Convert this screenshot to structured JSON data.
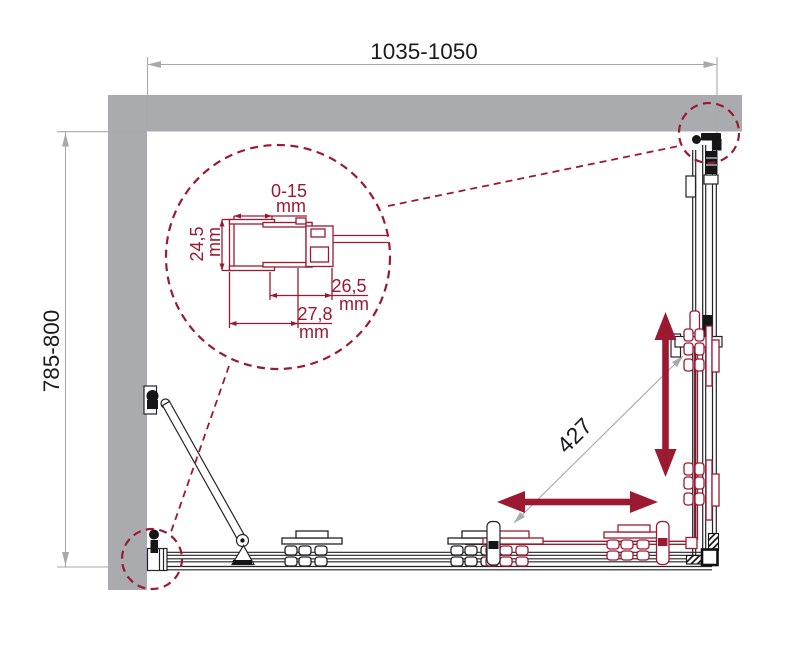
{
  "drawing": {
    "kind": "corner-shower-enclosure-plan-view",
    "dimensions": {
      "width": "1035-1050",
      "depth": "785-800",
      "diagonal": "427"
    },
    "profile_detail": {
      "adjustment": {
        "value": "0-15",
        "unit": "mm"
      },
      "depth": {
        "value": "24,5",
        "unit": "mm"
      },
      "width_inner": {
        "value": "26,5",
        "unit": "mm"
      },
      "width_outer": {
        "value": "27,8",
        "unit": "mm"
      }
    },
    "colors": {
      "wall_gray": "#a9abae",
      "accent_maroon": "#9b1a31",
      "line_black": "#1c1c1e",
      "dim_gray": "#a7a9ac"
    }
  }
}
